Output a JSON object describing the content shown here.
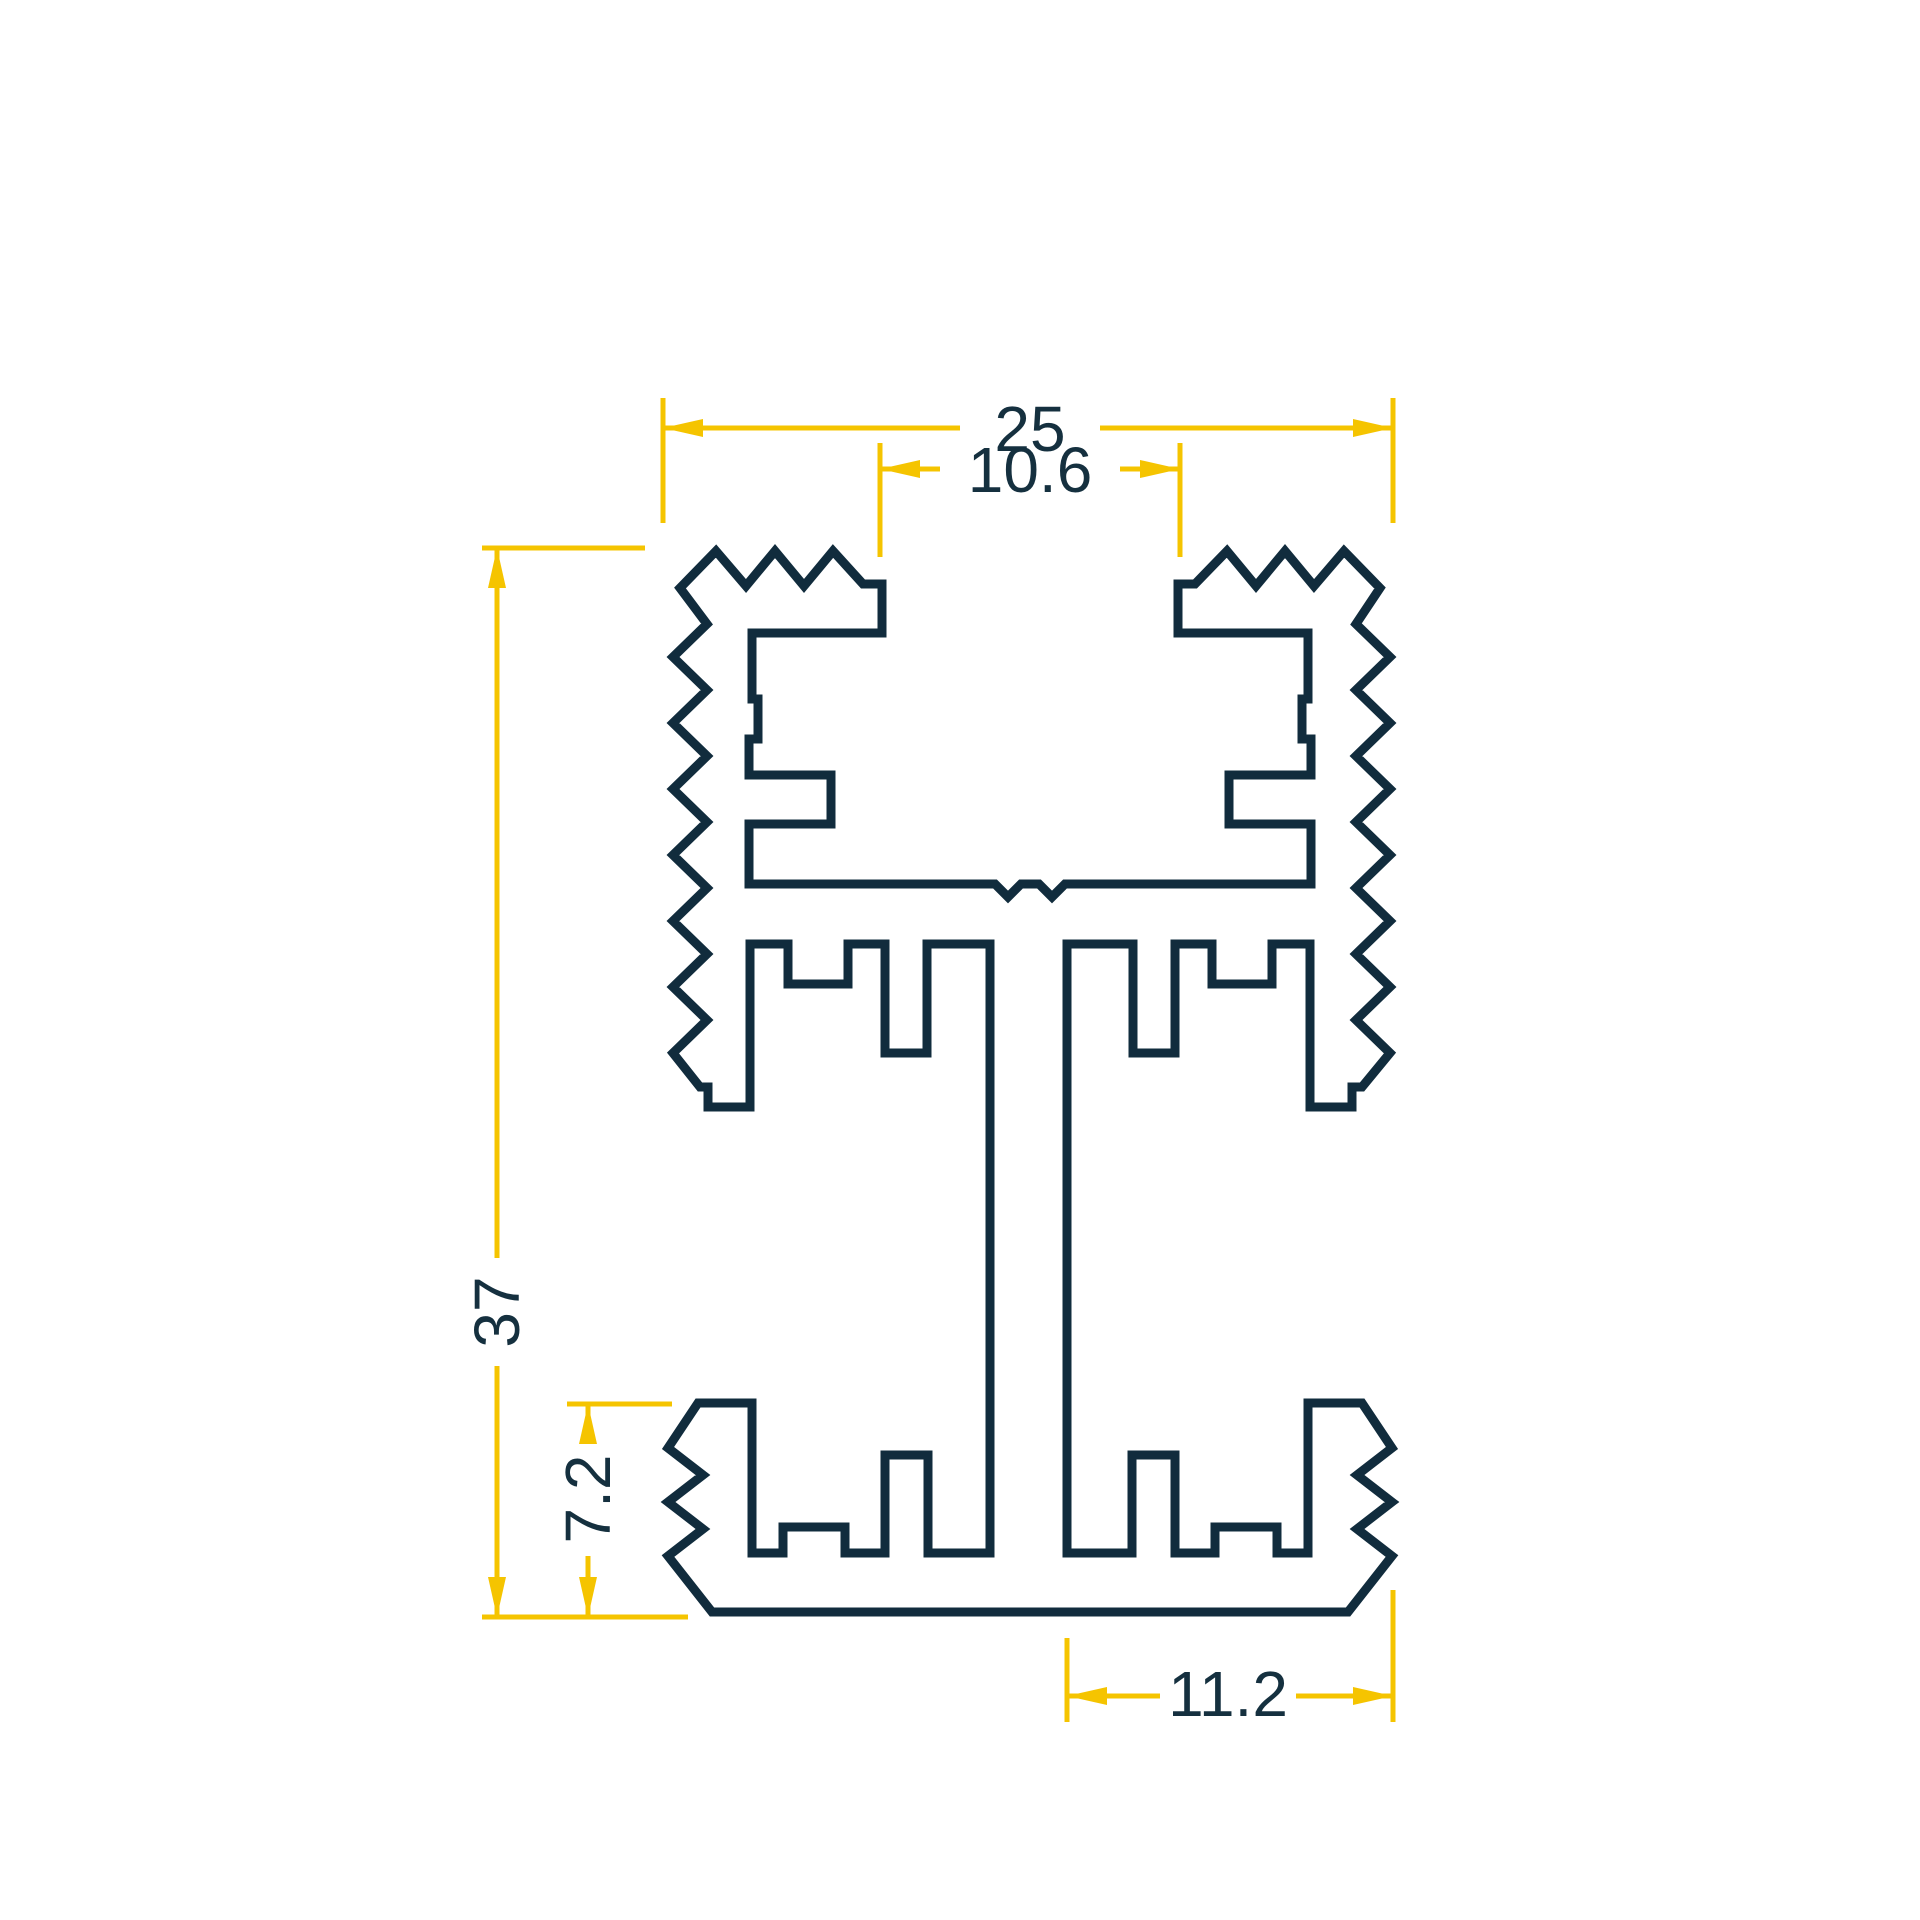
{
  "drawing": {
    "title": "aluminium-profile-cross-section",
    "canvas": {
      "width": 1920,
      "height": 1920
    },
    "colors": {
      "background": "#ffffff",
      "outline": "#112c3d",
      "dimension": "#f5c400",
      "text": "#15303f"
    },
    "stroke": {
      "outline_width": 9,
      "dimension_width": 5,
      "font_size": 64
    },
    "profile_outline": [
      [
        680,
        588
      ],
      [
        716,
        551
      ],
      [
        746,
        586
      ],
      [
        775,
        551
      ],
      [
        804,
        586
      ],
      [
        833,
        551
      ],
      [
        863,
        584
      ],
      [
        882,
        584
      ],
      [
        882,
        633
      ],
      [
        752,
        633
      ],
      [
        752,
        699
      ],
      [
        758,
        699
      ],
      [
        758,
        739
      ],
      [
        749,
        739
      ],
      [
        749,
        775
      ],
      [
        831,
        775
      ],
      [
        831,
        824
      ],
      [
        749,
        824
      ],
      [
        749,
        884
      ],
      [
        995,
        884
      ],
      [
        1008,
        897
      ],
      [
        1021,
        884
      ],
      [
        1039,
        884
      ],
      [
        1052,
        897
      ],
      [
        1065,
        884
      ],
      [
        1311,
        884
      ],
      [
        1311,
        824
      ],
      [
        1229,
        824
      ],
      [
        1229,
        775
      ],
      [
        1311,
        775
      ],
      [
        1311,
        739
      ],
      [
        1302,
        739
      ],
      [
        1302,
        699
      ],
      [
        1308,
        699
      ],
      [
        1308,
        633
      ],
      [
        1178,
        633
      ],
      [
        1178,
        584
      ],
      [
        1195,
        584
      ],
      [
        1227,
        551
      ],
      [
        1256,
        586
      ],
      [
        1285,
        551
      ],
      [
        1314,
        586
      ],
      [
        1344,
        551
      ],
      [
        1380,
        588
      ],
      [
        1356,
        624
      ],
      [
        1390,
        657
      ],
      [
        1356,
        690
      ],
      [
        1390,
        723
      ],
      [
        1356,
        756
      ],
      [
        1390,
        789
      ],
      [
        1356,
        822
      ],
      [
        1390,
        855
      ],
      [
        1356,
        888
      ],
      [
        1390,
        921
      ],
      [
        1356,
        954
      ],
      [
        1390,
        987
      ],
      [
        1356,
        1020
      ],
      [
        1390,
        1053
      ],
      [
        1362,
        1087
      ],
      [
        1352,
        1087
      ],
      [
        1352,
        1107
      ],
      [
        1310,
        1107
      ],
      [
        1310,
        944
      ],
      [
        1272,
        944
      ],
      [
        1272,
        984
      ],
      [
        1212,
        984
      ],
      [
        1212,
        944
      ],
      [
        1175,
        944
      ],
      [
        1175,
        1053
      ],
      [
        1133,
        1053
      ],
      [
        1133,
        944
      ],
      [
        1067,
        944
      ],
      [
        1067,
        1553
      ],
      [
        1132,
        1553
      ],
      [
        1132,
        1455
      ],
      [
        1175,
        1455
      ],
      [
        1175,
        1553
      ],
      [
        1215,
        1553
      ],
      [
        1215,
        1527
      ],
      [
        1277,
        1527
      ],
      [
        1277,
        1553
      ],
      [
        1308,
        1553
      ],
      [
        1308,
        1403
      ],
      [
        1362,
        1403
      ],
      [
        1392,
        1448
      ],
      [
        1357,
        1475
      ],
      [
        1392,
        1502
      ],
      [
        1357,
        1529
      ],
      [
        1392,
        1556
      ],
      [
        1348,
        1612
      ],
      [
        712,
        1612
      ],
      [
        668,
        1556
      ],
      [
        703,
        1529
      ],
      [
        668,
        1502
      ],
      [
        703,
        1475
      ],
      [
        668,
        1448
      ],
      [
        698,
        1403
      ],
      [
        752,
        1403
      ],
      [
        752,
        1553
      ],
      [
        783,
        1553
      ],
      [
        783,
        1527
      ],
      [
        845,
        1527
      ],
      [
        845,
        1553
      ],
      [
        885,
        1553
      ],
      [
        885,
        1455
      ],
      [
        928,
        1455
      ],
      [
        928,
        1553
      ],
      [
        990,
        1553
      ],
      [
        990,
        944
      ],
      [
        927,
        944
      ],
      [
        927,
        1053
      ],
      [
        885,
        1053
      ],
      [
        885,
        944
      ],
      [
        848,
        944
      ],
      [
        848,
        984
      ],
      [
        788,
        984
      ],
      [
        788,
        944
      ],
      [
        750,
        944
      ],
      [
        750,
        1107
      ],
      [
        708,
        1107
      ],
      [
        708,
        1087
      ],
      [
        700,
        1087
      ],
      [
        673,
        1053
      ],
      [
        707,
        1020
      ],
      [
        673,
        987
      ],
      [
        707,
        954
      ],
      [
        673,
        921
      ],
      [
        707,
        888
      ],
      [
        673,
        855
      ],
      [
        707,
        822
      ],
      [
        673,
        789
      ],
      [
        707,
        756
      ],
      [
        673,
        723
      ],
      [
        707,
        690
      ],
      [
        673,
        657
      ],
      [
        707,
        624
      ]
    ],
    "dimensions": [
      {
        "value": "25",
        "name": "dim-overall-width",
        "rotate": 0,
        "text_x": 1030,
        "text_y": 429,
        "lines": [
          [
            663,
            428,
            960,
            428
          ],
          [
            1100,
            428,
            1393,
            428
          ]
        ],
        "ext": [
          [
            663,
            398,
            663,
            523
          ],
          [
            1393,
            398,
            1393,
            523
          ]
        ],
        "arrows": [
          [
            663,
            428,
            "left"
          ],
          [
            1393,
            428,
            "right"
          ]
        ]
      },
      {
        "value": "10.6",
        "name": "dim-channel-opening",
        "rotate": 0,
        "text_x": 1030,
        "text_y": 470,
        "lines": [
          [
            880,
            469,
            940,
            469
          ],
          [
            1120,
            469,
            1180,
            469
          ]
        ],
        "ext": [
          [
            880,
            443,
            880,
            557
          ],
          [
            1180,
            443,
            1180,
            557
          ]
        ],
        "arrows": [
          [
            880,
            469,
            "left"
          ],
          [
            1180,
            469,
            "right"
          ]
        ]
      },
      {
        "value": "37",
        "name": "dim-overall-height",
        "rotate": -90,
        "text_x": 497,
        "text_y": 1312,
        "lines": [
          [
            497,
            548,
            497,
            1258
          ],
          [
            497,
            1366,
            497,
            1617
          ]
        ],
        "ext": [
          [
            482,
            548,
            645,
            548
          ],
          [
            482,
            1617,
            688,
            1617
          ]
        ],
        "arrows": [
          [
            497,
            548,
            "up"
          ],
          [
            497,
            1617,
            "down"
          ]
        ]
      },
      {
        "value": "7.2",
        "name": "dim-base-height",
        "rotate": -90,
        "text_x": 588,
        "text_y": 1499,
        "lines": [
          [
            588,
            1404,
            588,
            1443
          ],
          [
            588,
            1556,
            588,
            1617
          ]
        ],
        "ext": [
          [
            567,
            1404,
            672,
            1404
          ]
        ],
        "arrows": [
          [
            588,
            1404,
            "up"
          ],
          [
            588,
            1617,
            "down"
          ]
        ]
      },
      {
        "value": "11.2",
        "name": "dim-base-half-width",
        "rotate": 0,
        "text_x": 1228,
        "text_y": 1694,
        "lines": [
          [
            1067,
            1696,
            1160,
            1696
          ],
          [
            1296,
            1696,
            1393,
            1696
          ]
        ],
        "ext": [
          [
            1067,
            1638,
            1067,
            1722
          ],
          [
            1393,
            1590,
            1393,
            1722
          ]
        ],
        "arrows": [
          [
            1067,
            1696,
            "left"
          ],
          [
            1393,
            1696,
            "right"
          ]
        ]
      }
    ]
  }
}
